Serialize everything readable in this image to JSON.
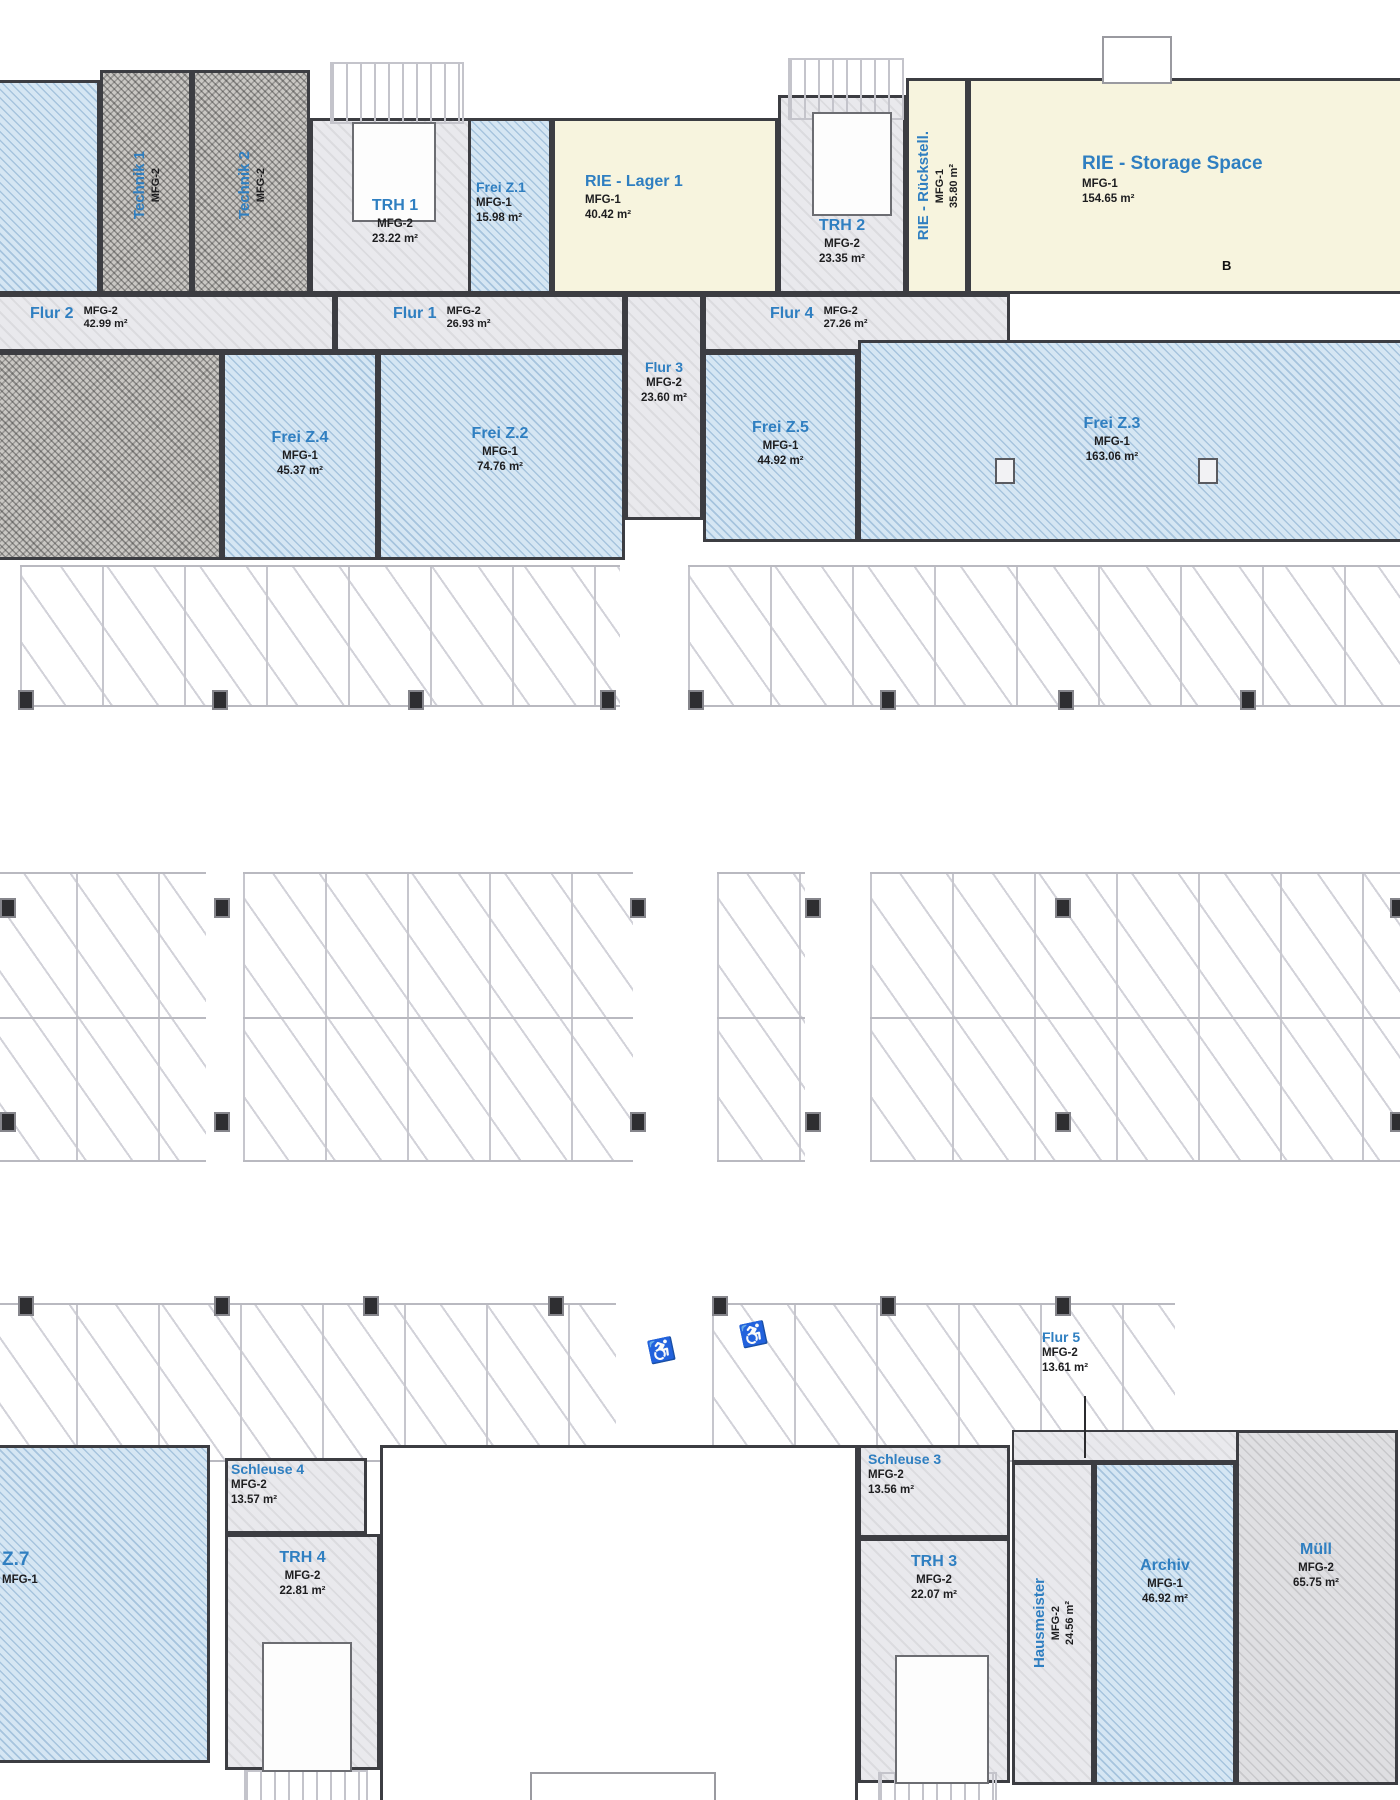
{
  "plan_title": "Floor plan – parking level with rooms",
  "colors": {
    "free_zone_fill": "#d5e6f3",
    "rie_fill": "#f7f4de",
    "corridor_fill": "#e9e9ed",
    "label_blue": "#2f7fc1",
    "label_black": "#1d1d1f",
    "wall": "#3c3d42"
  },
  "rooms": {
    "technik1": {
      "name": "Technik 1",
      "code": "MFG-2"
    },
    "technik2": {
      "name": "Technik 2",
      "code": "MFG-2"
    },
    "trh1": {
      "name": "TRH 1",
      "code": "MFG-2",
      "area": "23.22 m²"
    },
    "freiz1": {
      "name": "Frei Z.1",
      "code": "MFG-1",
      "area": "15.98 m²"
    },
    "lager1": {
      "name": "RIE - Lager 1",
      "code": "MFG-1",
      "area": "40.42 m²"
    },
    "trh2": {
      "name": "TRH 2",
      "code": "MFG-2",
      "area": "23.35 m²"
    },
    "rueckstell": {
      "name": "RIE - Rückstell.",
      "code": "MFG-1",
      "area": "35.80 m²"
    },
    "storage": {
      "name": "RIE - Storage Space",
      "code": "MFG-1",
      "area": "154.65 m²",
      "marker": "B"
    },
    "flur2": {
      "name": "Flur 2",
      "code": "MFG-2",
      "area": "42.99 m²"
    },
    "flur1": {
      "name": "Flur 1",
      "code": "MFG-2",
      "area": "26.93 m²"
    },
    "flur4": {
      "name": "Flur 4",
      "code": "MFG-2",
      "area": "27.26 m²"
    },
    "flur3": {
      "name": "Flur 3",
      "code": "MFG-2",
      "area": "23.60 m²"
    },
    "freiz4": {
      "name": "Frei Z.4",
      "code": "MFG-1",
      "area": "45.37 m²"
    },
    "freiz2": {
      "name": "Frei Z.2",
      "code": "MFG-1",
      "area": "74.76 m²"
    },
    "freiz5": {
      "name": "Frei Z.5",
      "code": "MFG-1",
      "area": "44.92 m²"
    },
    "freiz3": {
      "name": "Frei Z.3",
      "code": "MFG-1",
      "area": "163.06 m²"
    },
    "z7": {
      "name": "Z.7",
      "code": "MFG-1"
    },
    "schleuse4": {
      "name": "Schleuse 4",
      "code": "MFG-2",
      "area": "13.57 m²"
    },
    "trh4": {
      "name": "TRH 4",
      "code": "MFG-2",
      "area": "22.81 m²"
    },
    "schleuse3": {
      "name": "Schleuse 3",
      "code": "MFG-2",
      "area": "13.56 m²"
    },
    "trh3": {
      "name": "TRH 3",
      "code": "MFG-2",
      "area": "22.07 m²"
    },
    "flur5": {
      "name": "Flur 5",
      "code": "MFG-2",
      "area": "13.61 m²"
    },
    "hausmeister": {
      "name": "Hausmeister",
      "code": "MFG-2",
      "area": "24.56 m²"
    },
    "archiv": {
      "name": "Archiv",
      "code": "MFG-1",
      "area": "46.92 m²"
    },
    "muell": {
      "name": "Müll",
      "code": "MFG-2",
      "area": "65.75 m²"
    }
  },
  "icons": {
    "wheelchair": "♿"
  }
}
